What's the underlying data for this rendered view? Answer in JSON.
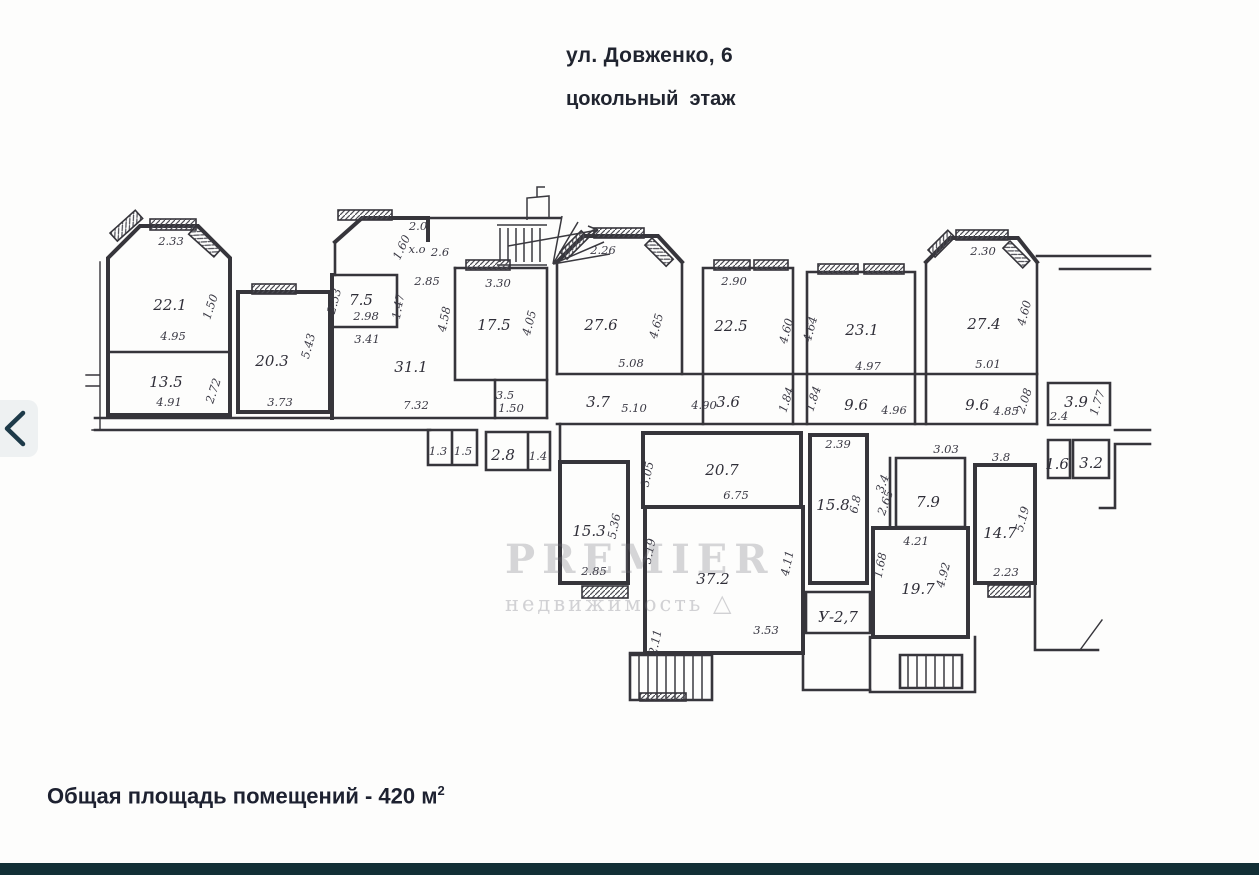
{
  "header": {
    "title": "ул. Довженко, 6",
    "subtitle": "цокольный  этаж"
  },
  "footer": {
    "total_area_text": "Общая площадь помещений - 420 м",
    "superscript": "2"
  },
  "watermark": {
    "line1": "PREMIER",
    "line2": "недвижимость",
    "logo": "△"
  },
  "colors": {
    "accent_bar": "#122f36",
    "ink": "#36353b",
    "nav_bg": "#eef1f2",
    "nav_chevron": "#1d3a49"
  },
  "plan": {
    "labels": [
      {
        "t": "22.1",
        "x": 170,
        "y": 310,
        "k": "area"
      },
      {
        "t": "13.5",
        "x": 166,
        "y": 387,
        "k": "area"
      },
      {
        "t": "20.3",
        "x": 272,
        "y": 366,
        "k": "area"
      },
      {
        "t": "7.5",
        "x": 361,
        "y": 305,
        "k": "area"
      },
      {
        "t": "31.1",
        "x": 411,
        "y": 372,
        "k": "area"
      },
      {
        "t": "17.5",
        "x": 494,
        "y": 330,
        "k": "area"
      },
      {
        "t": "27.6",
        "x": 601,
        "y": 330,
        "k": "area"
      },
      {
        "t": "22.5",
        "x": 731,
        "y": 331,
        "k": "area"
      },
      {
        "t": "23.1",
        "x": 862,
        "y": 335,
        "k": "area"
      },
      {
        "t": "27.4",
        "x": 984,
        "y": 329,
        "k": "area"
      },
      {
        "t": "3.7",
        "x": 598,
        "y": 407,
        "k": "area"
      },
      {
        "t": "3.6",
        "x": 728,
        "y": 407,
        "k": "area"
      },
      {
        "t": "9.6",
        "x": 856,
        "y": 410,
        "k": "area"
      },
      {
        "t": "9.6",
        "x": 977,
        "y": 410,
        "k": "area"
      },
      {
        "t": "3.5",
        "x": 505,
        "y": 399,
        "k": "dim"
      },
      {
        "t": "3.9",
        "x": 1076,
        "y": 407,
        "k": "area"
      },
      {
        "t": "1.6",
        "x": 1057,
        "y": 469,
        "k": "area"
      },
      {
        "t": "3.2",
        "x": 1091,
        "y": 468,
        "k": "area"
      },
      {
        "t": "1.3",
        "x": 438,
        "y": 455,
        "k": "dim"
      },
      {
        "t": "1.5",
        "x": 463,
        "y": 455,
        "k": "dim"
      },
      {
        "t": "2.8",
        "x": 503,
        "y": 460,
        "k": "area"
      },
      {
        "t": "1.4",
        "x": 538,
        "y": 460,
        "k": "dim"
      },
      {
        "t": "15.3",
        "x": 589,
        "y": 536,
        "k": "area"
      },
      {
        "t": "20.7",
        "x": 722,
        "y": 475,
        "k": "area"
      },
      {
        "t": "37.2",
        "x": 713,
        "y": 584,
        "k": "area"
      },
      {
        "t": "15.8",
        "x": 833,
        "y": 510,
        "k": "area"
      },
      {
        "t": "7.9",
        "x": 928,
        "y": 507,
        "k": "area"
      },
      {
        "t": "19.7",
        "x": 918,
        "y": 594,
        "k": "area"
      },
      {
        "t": "14.7",
        "x": 1000,
        "y": 538,
        "k": "area"
      },
      {
        "t": "У-2,7",
        "x": 838,
        "y": 622,
        "k": "area"
      },
      {
        "t": "2.33",
        "x": 171,
        "y": 245,
        "k": "dim"
      },
      {
        "t": "4.95",
        "x": 173,
        "y": 340,
        "k": "dim"
      },
      {
        "t": "1.50",
        "x": 214,
        "y": 308,
        "k": "dim",
        "r": -72
      },
      {
        "t": "4.91",
        "x": 169,
        "y": 406,
        "k": "dim"
      },
      {
        "t": "2.72",
        "x": 217,
        "y": 392,
        "k": "dim",
        "r": -72
      },
      {
        "t": "3.73",
        "x": 280,
        "y": 406,
        "k": "dim"
      },
      {
        "t": "5.43",
        "x": 312,
        "y": 347,
        "k": "dim",
        "r": -75
      },
      {
        "t": "2.53",
        "x": 338,
        "y": 302,
        "k": "dim",
        "r": -75
      },
      {
        "t": "2.98",
        "x": 366,
        "y": 320,
        "k": "dim"
      },
      {
        "t": "3.41",
        "x": 367,
        "y": 343,
        "k": "dim"
      },
      {
        "t": "1.47",
        "x": 402,
        "y": 307,
        "k": "dim",
        "r": -80
      },
      {
        "t": "2.0",
        "x": 418,
        "y": 230,
        "k": "dim"
      },
      {
        "t": "1.60",
        "x": 405,
        "y": 249,
        "k": "dim",
        "r": -65
      },
      {
        "t": "х.о",
        "x": 417,
        "y": 253,
        "k": "dim"
      },
      {
        "t": "2.6",
        "x": 440,
        "y": 256,
        "k": "dim"
      },
      {
        "t": "2.85",
        "x": 427,
        "y": 285,
        "k": "dim"
      },
      {
        "t": "4.58",
        "x": 448,
        "y": 320,
        "k": "dim",
        "r": -78
      },
      {
        "t": "3.30",
        "x": 498,
        "y": 287,
        "k": "dim"
      },
      {
        "t": "4.05",
        "x": 533,
        "y": 324,
        "k": "dim",
        "r": -75
      },
      {
        "t": "7.32",
        "x": 416,
        "y": 409,
        "k": "dim"
      },
      {
        "t": "1.50",
        "x": 511,
        "y": 412,
        "k": "dim"
      },
      {
        "t": "2.26",
        "x": 603,
        "y": 254,
        "k": "dim"
      },
      {
        "t": "5.08",
        "x": 631,
        "y": 367,
        "k": "dim"
      },
      {
        "t": "4.65",
        "x": 660,
        "y": 327,
        "k": "dim",
        "r": -75
      },
      {
        "t": "2.90",
        "x": 734,
        "y": 285,
        "k": "dim"
      },
      {
        "t": "4.60",
        "x": 790,
        "y": 332,
        "k": "dim",
        "r": -75
      },
      {
        "t": "4.90",
        "x": 704,
        "y": 409,
        "k": "dim"
      },
      {
        "t": "1.84",
        "x": 790,
        "y": 401,
        "k": "dim",
        "r": -72
      },
      {
        "t": "1.84",
        "x": 817,
        "y": 400,
        "k": "dim",
        "r": -72
      },
      {
        "t": "4.97",
        "x": 868,
        "y": 370,
        "k": "dim"
      },
      {
        "t": "4.64",
        "x": 814,
        "y": 330,
        "k": "dim",
        "r": -75
      },
      {
        "t": "5.10",
        "x": 634,
        "y": 412,
        "k": "dim"
      },
      {
        "t": "4.96",
        "x": 894,
        "y": 414,
        "k": "dim"
      },
      {
        "t": "2.30",
        "x": 983,
        "y": 255,
        "k": "dim"
      },
      {
        "t": "5.01",
        "x": 988,
        "y": 368,
        "k": "dim"
      },
      {
        "t": "4.60",
        "x": 1028,
        "y": 314,
        "k": "dim",
        "r": -75
      },
      {
        "t": "4.85",
        "x": 1006,
        "y": 415,
        "k": "dim"
      },
      {
        "t": "2.08",
        "x": 1028,
        "y": 402,
        "k": "dim",
        "r": -72
      },
      {
        "t": "2.4",
        "x": 1059,
        "y": 420,
        "k": "dim"
      },
      {
        "t": "1.77",
        "x": 1101,
        "y": 404,
        "k": "dim",
        "r": -72
      },
      {
        "t": "2.39",
        "x": 838,
        "y": 448,
        "k": "dim"
      },
      {
        "t": "6.8",
        "x": 859,
        "y": 505,
        "k": "dim",
        "r": -78
      },
      {
        "t": "3.05",
        "x": 651,
        "y": 475,
        "k": "dim",
        "r": -78
      },
      {
        "t": "6.75",
        "x": 736,
        "y": 499,
        "k": "dim"
      },
      {
        "t": "5.36",
        "x": 618,
        "y": 527,
        "k": "dim",
        "r": -78
      },
      {
        "t": "2.85",
        "x": 594,
        "y": 575,
        "k": "dim"
      },
      {
        "t": "3.19",
        "x": 653,
        "y": 552,
        "k": "dim",
        "r": -78
      },
      {
        "t": "4.11",
        "x": 791,
        "y": 564,
        "k": "dim",
        "r": -78
      },
      {
        "t": "3.53",
        "x": 766,
        "y": 634,
        "k": "dim"
      },
      {
        "t": "2.11",
        "x": 659,
        "y": 643,
        "k": "dim",
        "r": -78
      },
      {
        "t": "3.03",
        "x": 946,
        "y": 453,
        "k": "dim"
      },
      {
        "t": "3.4",
        "x": 886,
        "y": 485,
        "k": "dim",
        "r": -70
      },
      {
        "t": "2.65",
        "x": 889,
        "y": 504,
        "k": "dim",
        "r": -70
      },
      {
        "t": "4.21",
        "x": 916,
        "y": 545,
        "k": "dim"
      },
      {
        "t": "1.68",
        "x": 884,
        "y": 566,
        "k": "dim",
        "r": -78
      },
      {
        "t": "4.92",
        "x": 947,
        "y": 576,
        "k": "dim",
        "r": -75
      },
      {
        "t": "3.8",
        "x": 1001,
        "y": 461,
        "k": "dim"
      },
      {
        "t": "5.19",
        "x": 1026,
        "y": 520,
        "k": "dim",
        "r": -75
      },
      {
        "t": "2.23",
        "x": 1006,
        "y": 576,
        "k": "dim"
      }
    ]
  }
}
